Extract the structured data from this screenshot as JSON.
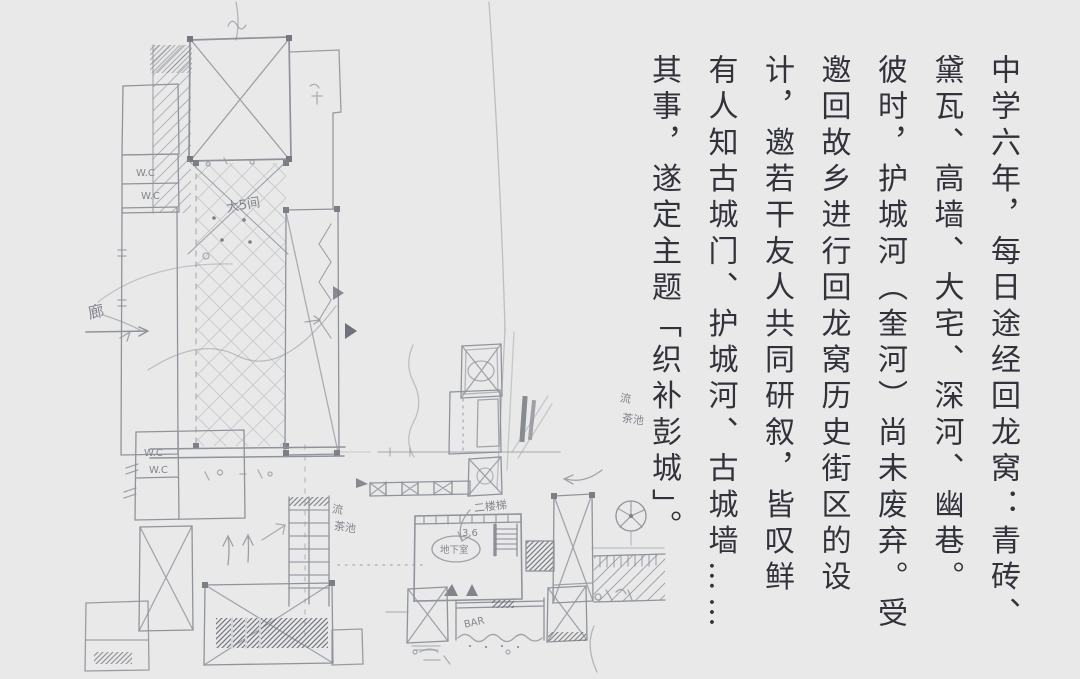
{
  "canvas": {
    "background": "#e9e9e9",
    "width": 1080,
    "height": 675
  },
  "essay": {
    "color": "#32333a",
    "direction": "vertical-rl",
    "columns": [
      "中学六年，每日途经回龙窝：青砖、",
      "黛瓦、高墙、大宅、深河、幽巷。",
      "彼时，护城河（奎河）尚未废弃。受",
      "邀回故乡进行回龙窝历史街区的设",
      "计，邀若干友人共同研叙，皆叹鲜",
      "有人知古城门、护城河、古城墙……",
      "其事，遂定主题「织补彭城」。"
    ]
  },
  "sketch": {
    "stroke_color": "#8f939b",
    "labels": {
      "corridor": "廊",
      "big_room": "大5间",
      "wc_a": "W.C",
      "wc_b": "W.C",
      "wc_c": "W.C",
      "wc_d": "W.C",
      "flow_a": "流",
      "tea_a": "茶池",
      "flow_b": "流",
      "tea_b": "茶池",
      "upstairs": "二楼梯",
      "depth": "3.6",
      "basement": "地下室",
      "bar": "BAR"
    }
  }
}
